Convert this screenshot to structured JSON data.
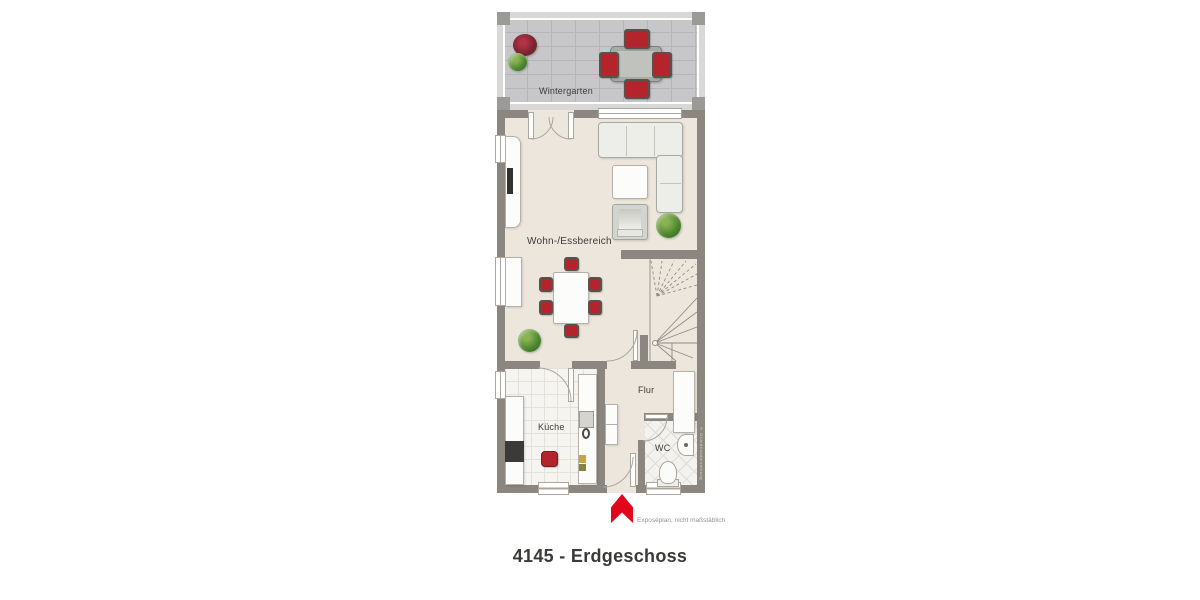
{
  "title": "4145 - Erdgeschoss",
  "disclaimer": "Exposéplan, nicht maßstäblich",
  "watermark": "© Grundrissdarstellung",
  "rooms": {
    "wintergarten": {
      "label": "Wintergarten"
    },
    "living": {
      "label": "Wohn-/Essbereich"
    },
    "kitchen": {
      "label": "Küche"
    },
    "hall": {
      "label": "Flur"
    },
    "wc": {
      "label": "WC"
    }
  },
  "icons": {
    "north_arrow": "red-up-arrow-logo"
  },
  "colors": {
    "wall": "#8C8680",
    "floor_main": "#ECE6DC",
    "tile_wintergarten": "#C7C7CA",
    "tile_kitchen": "#F5F4F0",
    "accent_red": "#E2051C",
    "furniture_red": "#B3242B",
    "text_dark": "#3B3B39",
    "text_muted": "#97938E"
  }
}
